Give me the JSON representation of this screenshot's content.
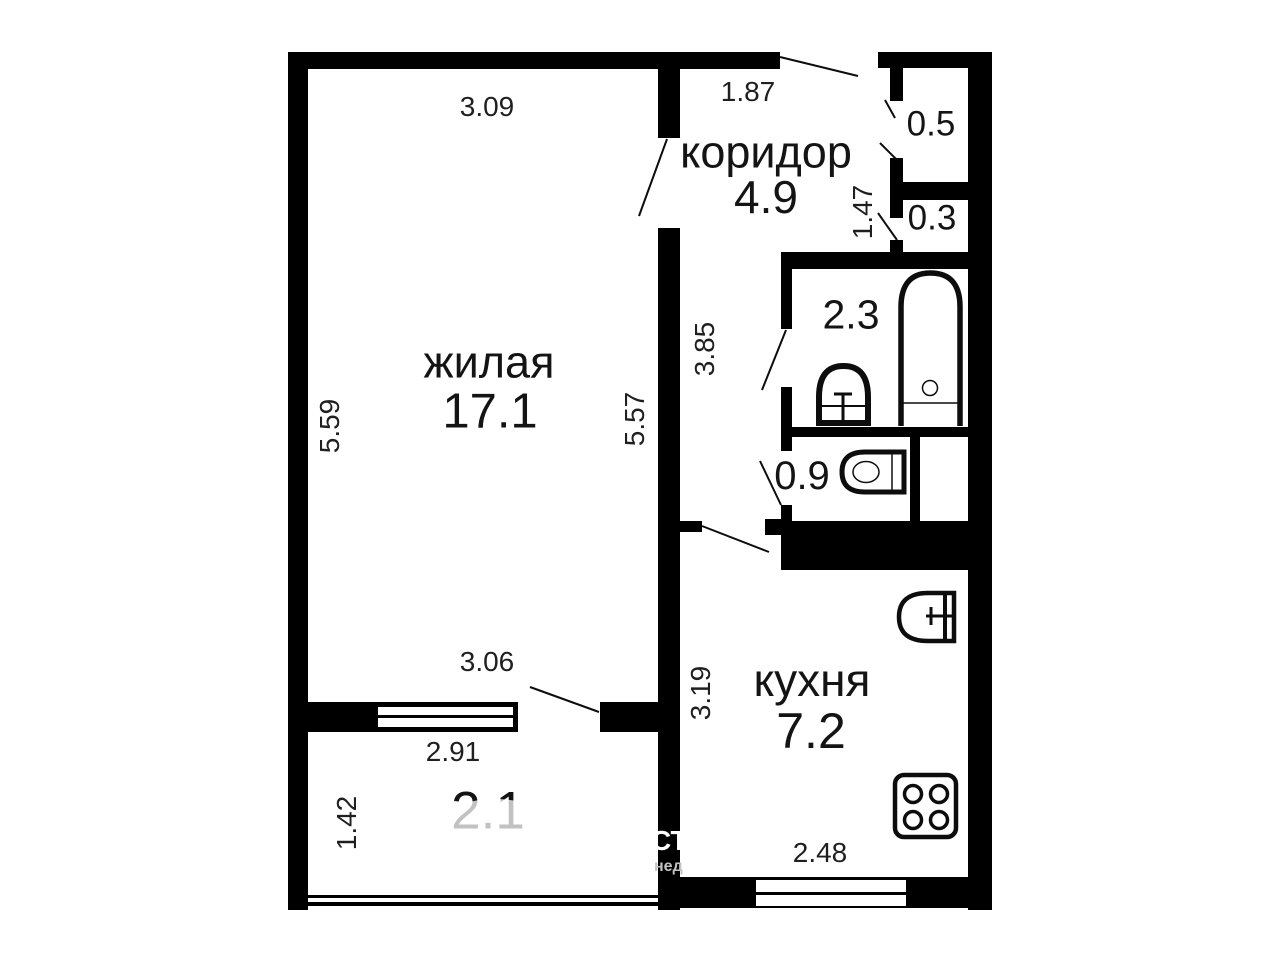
{
  "plan_title": "apartment-floorplan",
  "colors": {
    "wall": "#000000",
    "fixture_stroke": "#0d0d0d",
    "room_text": "#141414",
    "dim_text": "#1f1f1f",
    "watermark_white": "#ffffff",
    "watermark_grey": "#c3c3c3",
    "background": "#ffffff"
  },
  "rooms": {
    "living": {
      "name": "жилая",
      "area": "17.1"
    },
    "corridor": {
      "name": "коридор",
      "area": "4.9"
    },
    "kitchen": {
      "name": "кухня",
      "area": "7.2"
    },
    "bathroom": {
      "area": "2.3"
    },
    "toilet": {
      "area": "0.9"
    },
    "storage_upper": {
      "area": "0.5"
    },
    "storage_lower": {
      "area": "0.3"
    },
    "balcony": {
      "area": "2.1"
    }
  },
  "dimensions": {
    "living_top": "3.09",
    "entry_top": "1.87",
    "living_left": "5.59",
    "living_right": "5.57",
    "corridor_left": "3.85",
    "storage_left": "1.47",
    "living_bottom": "3.06",
    "balcony_top": "2.91",
    "balcony_left": "1.42",
    "kitchen_left": "3.19",
    "kitchen_bottom": "2.48"
  },
  "fixtures": [
    "bathtub",
    "washbasin",
    "toilet",
    "kitchen-sink",
    "stove",
    "window",
    "balcony-railing"
  ],
  "watermark": {
    "line1": "СТ",
    "line2": "нед"
  }
}
